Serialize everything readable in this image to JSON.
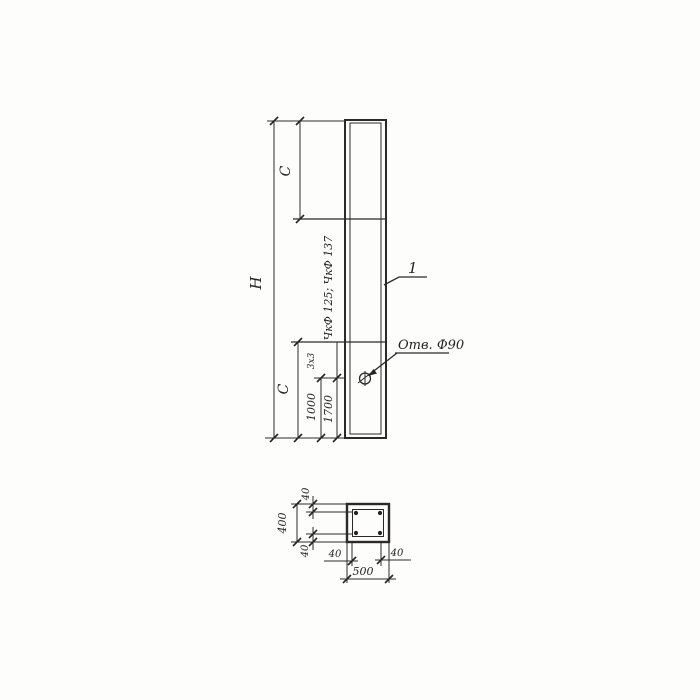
{
  "drawing": {
    "type": "technical-drawing-scan",
    "colors": {
      "paper": "#fdfdfb",
      "ink": "#2c2a26"
    },
    "elevation": {
      "part_callout": "1",
      "height_label": "H",
      "top_offset_label": "C",
      "bottom_offset_label": "C",
      "hole_note": "Отв. Ф90",
      "hole_dim_variant_1": "1000",
      "hole_dim_variant_2": "1700",
      "small_note": "3х3",
      "marks_note": "ЧкФ 125; ЧкФ 137"
    },
    "section": {
      "overall_width": "500",
      "overall_height": "400",
      "cover_top": "40",
      "cover_bottom": "40",
      "cover_left": "40",
      "cover_right": "40"
    }
  }
}
